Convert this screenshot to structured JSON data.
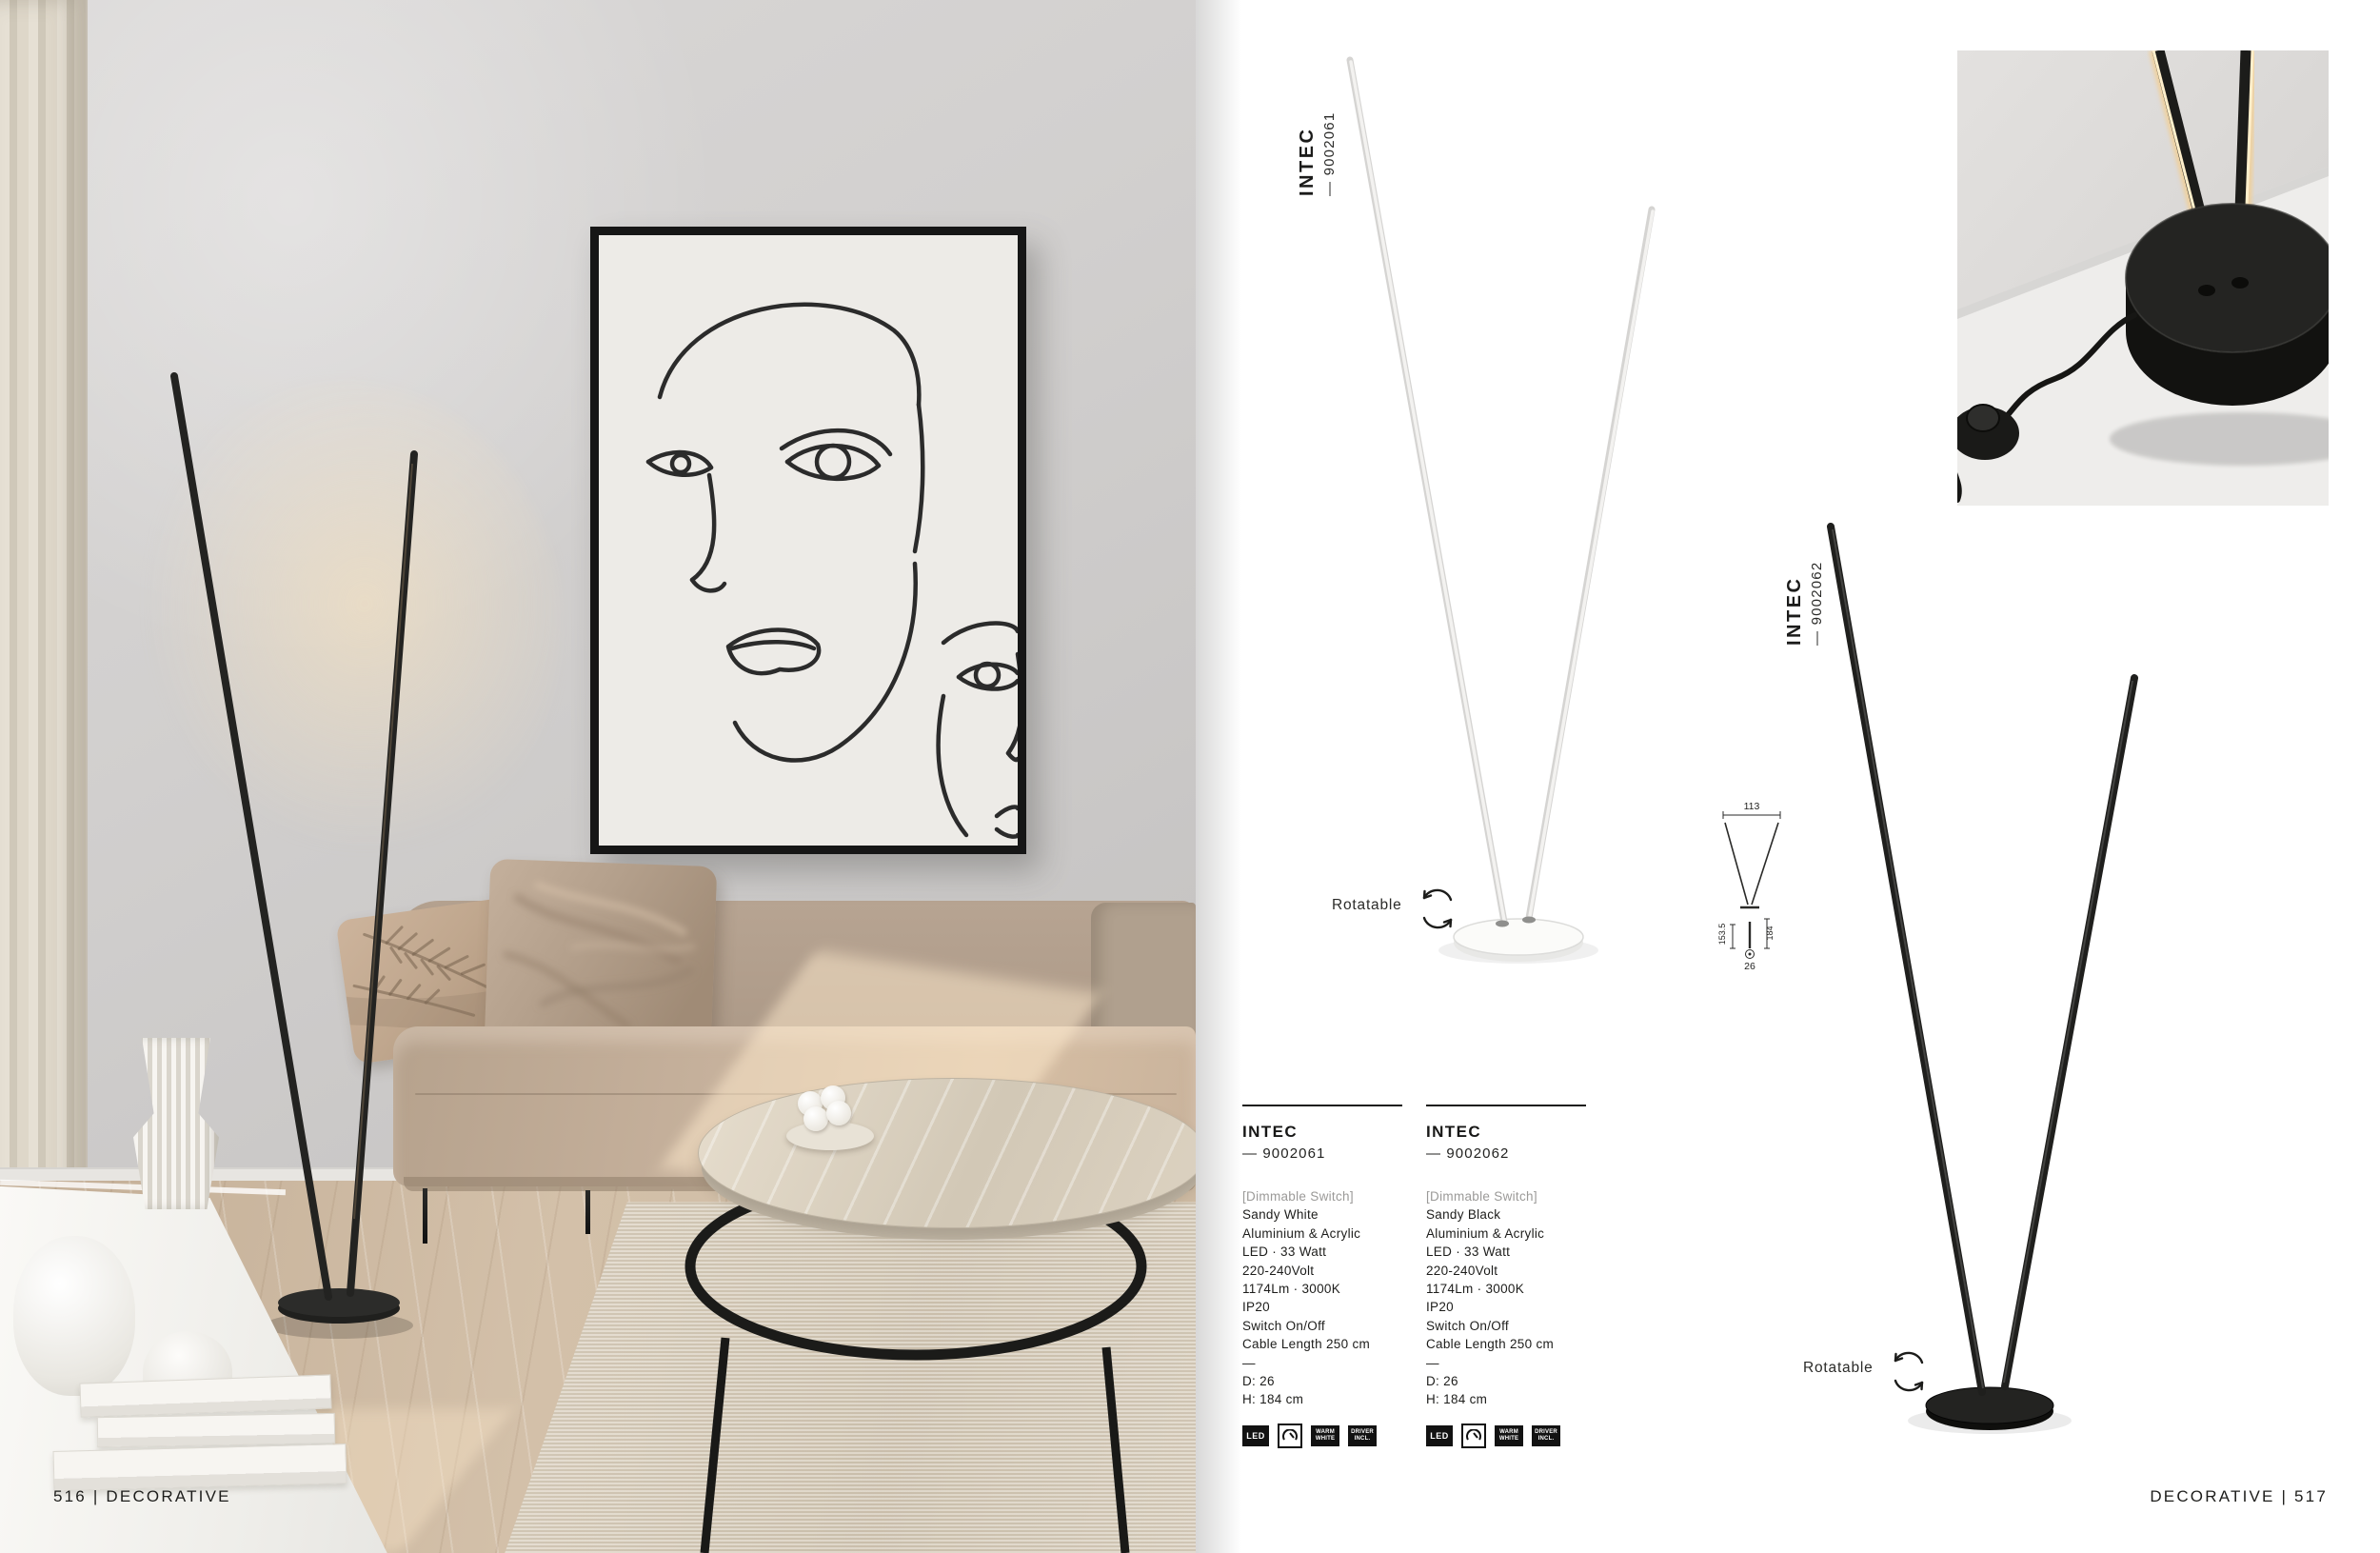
{
  "footer": {
    "left": "516 | DECORATIVE",
    "right": "DECORATIVE | 517"
  },
  "rotatable": "Rotatable",
  "vertical_labels": [
    {
      "name": "INTEC",
      "sku": "— 9002061"
    },
    {
      "name": "INTEC",
      "sku": "— 9002062"
    }
  ],
  "diagram": {
    "width": "113",
    "inner_height": "153.5",
    "total_height": "184",
    "base_diameter": "26"
  },
  "spec_columns": [
    {
      "name": "INTEC",
      "sku": "— 9002061",
      "feature": "[Dimmable Switch]",
      "lines": [
        "Sandy White",
        "Aluminium & Acrylic",
        "LED · 33 Watt",
        "220-240Volt",
        "1174Lm · 3000K",
        "IP20",
        "Switch On/Off",
        "Cable Length 250 cm"
      ],
      "sep": "—",
      "diameter": "D: 26",
      "height": "H: 184 cm"
    },
    {
      "name": "INTEC",
      "sku": "— 9002062",
      "feature": "[Dimmable Switch]",
      "lines": [
        "Sandy Black",
        "Aluminium & Acrylic",
        "LED · 33 Watt",
        "220-240Volt",
        "1174Lm · 3000K",
        "IP20",
        "Switch On/Off",
        "Cable Length 250 cm"
      ],
      "sep": "—",
      "diameter": "D: 26",
      "height": "H: 184 cm"
    }
  ],
  "badges": {
    "led": "LED",
    "warm_line1": "WARM",
    "warm_line2": "WHITE",
    "driver_line1": "DRIVER",
    "driver_line2": "INCL."
  },
  "colors": {
    "accent": "#1a1a1a",
    "muted": "#9b9a98",
    "glow": "#f6d9a2"
  }
}
